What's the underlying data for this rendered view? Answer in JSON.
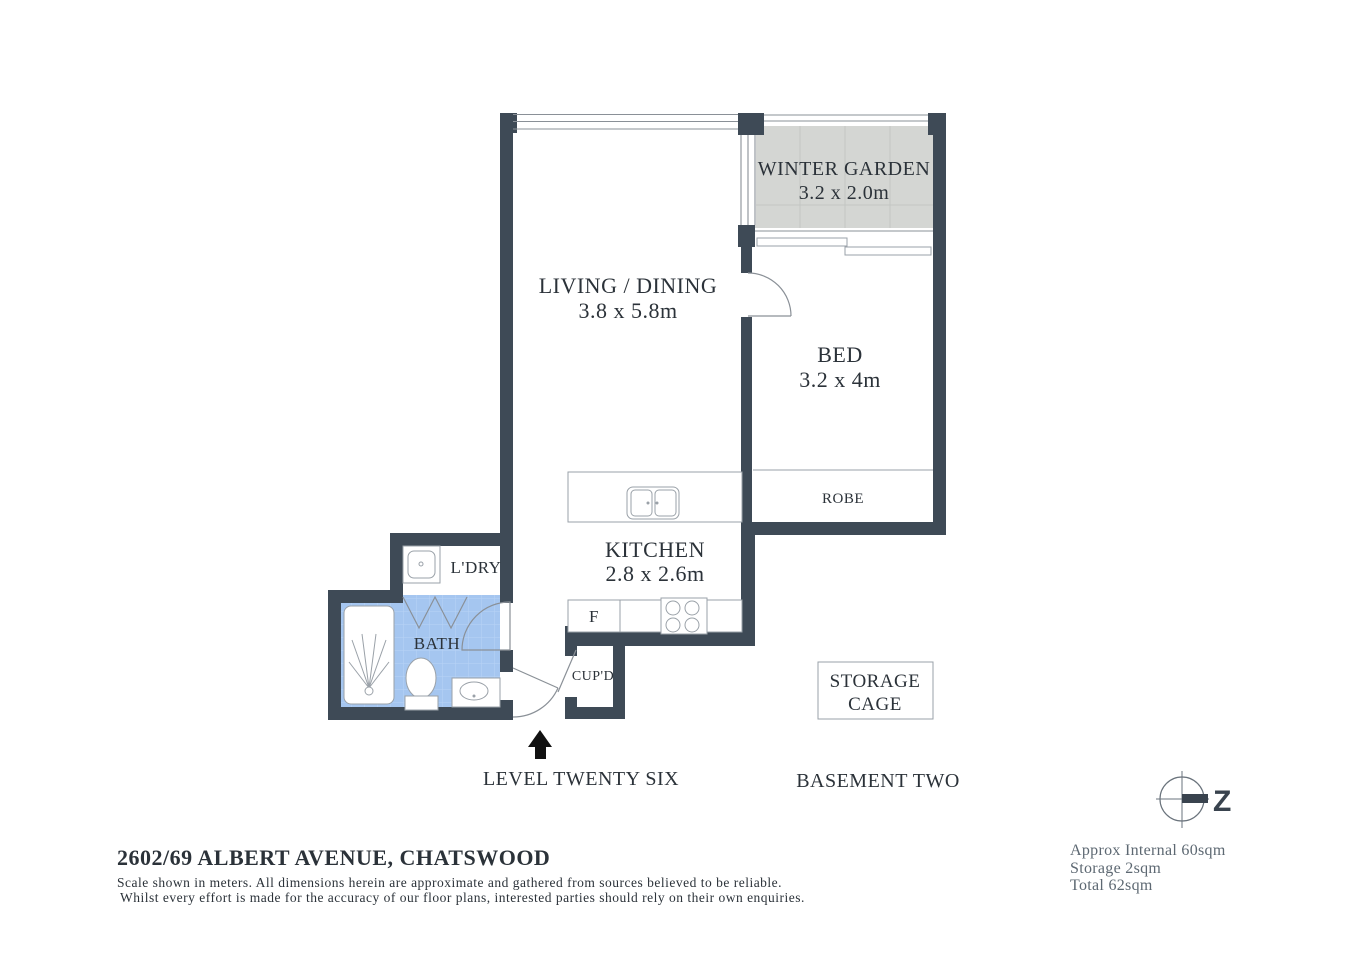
{
  "plan": {
    "rooms": {
      "winter_garden": {
        "name": "WINTER GARDEN",
        "dims": "3.2 x 2.0m"
      },
      "living_dining": {
        "name": "LIVING / DINING",
        "dims": "3.8 x 5.8m"
      },
      "bed": {
        "name": "BED",
        "dims": "3.2 x 4m"
      },
      "kitchen": {
        "name": "KITCHEN",
        "dims": "2.8 x 2.6m"
      },
      "robe": {
        "name": "ROBE"
      },
      "laundry": {
        "name": "L'DRY"
      },
      "bath": {
        "name": "BATH"
      },
      "cupboard": {
        "name": "CUP'D"
      },
      "fridge": {
        "name": "F"
      }
    },
    "storage_cage": {
      "line1": "STORAGE",
      "line2": "CAGE"
    },
    "level_label": "LEVEL TWENTY SIX",
    "basement_label": "BASEMENT TWO",
    "compass_label": "Z"
  },
  "footer": {
    "address": "2602/69 ALBERT AVENUE, CHATSWOOD",
    "disclaimer_line1": "Scale shown in meters. All dimensions herein are approximate and gathered from sources believed to be  reliable.",
    "disclaimer_line2": "Whilst every effort is made for the accuracy of our floor plans, interested parties should rely on their own enquiries.",
    "areas": {
      "internal": "Approx Internal 60sqm",
      "storage": "Storage 2sqm",
      "total": "Total 62sqm"
    }
  },
  "colors": {
    "wall": "#3e4a56",
    "bath_fill": "#a5c6f0",
    "bath_grid": "#b9d4f6",
    "bath_text": "#1c2540",
    "winter_garden_fill": "#d4d6d3",
    "text": "#2b3239",
    "muted_text": "#5d6872",
    "fixture_stroke": "#9aa1a8",
    "arrow": "#111111"
  }
}
